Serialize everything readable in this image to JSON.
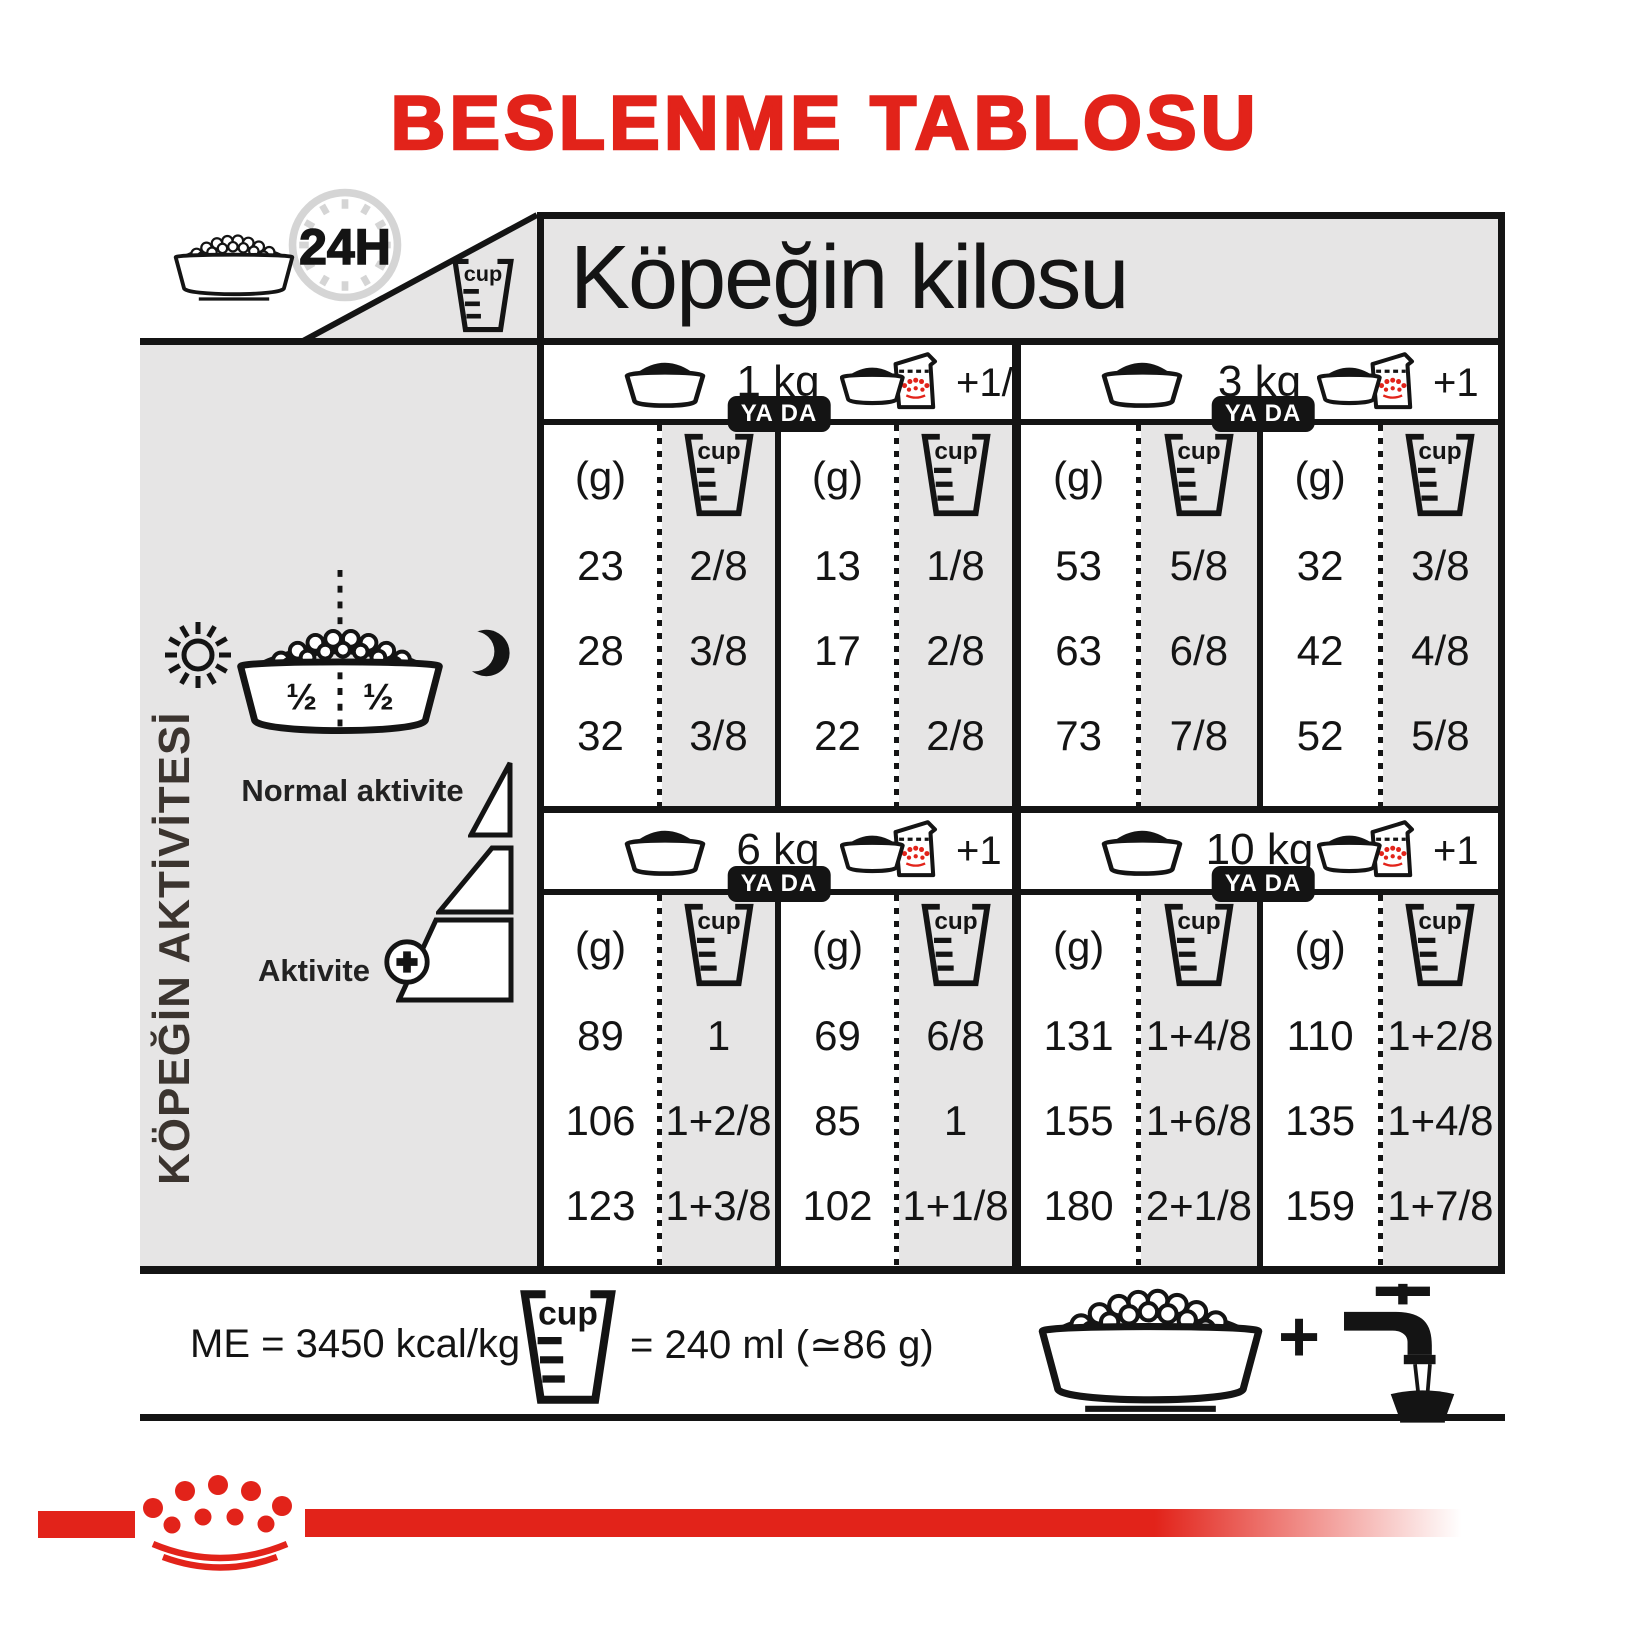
{
  "title": "BESLENME TABLOSU",
  "labels": {
    "cup": "cup",
    "hours": "24H",
    "grams": "(g)",
    "or": "YA DA",
    "plus": "+"
  },
  "weight_header": "Köpeğin kilosu",
  "sidebar": {
    "axis_label": "KÖPEĞİN AKTİVİTESİ",
    "half_left": "½",
    "half_right": "½",
    "normal_activity": "Normal aktivite",
    "activity": "Aktivite"
  },
  "sections": [
    {
      "weight": "1 kg",
      "add": "+1/2",
      "dry_g": [
        "23",
        "28",
        "32"
      ],
      "dry_cup": [
        "2/8",
        "3/8",
        "3/8"
      ],
      "mix_g": [
        "13",
        "17",
        "22"
      ],
      "mix_cup": [
        "1/8",
        "2/8",
        "2/8"
      ]
    },
    {
      "weight": "3 kg",
      "add": "+1",
      "dry_g": [
        "53",
        "63",
        "73"
      ],
      "dry_cup": [
        "5/8",
        "6/8",
        "7/8"
      ],
      "mix_g": [
        "32",
        "42",
        "52"
      ],
      "mix_cup": [
        "3/8",
        "4/8",
        "5/8"
      ]
    },
    {
      "weight": "6 kg",
      "add": "+1",
      "dry_g": [
        "89",
        "106",
        "123"
      ],
      "dry_cup": [
        "1",
        "1+2/8",
        "1+3/8"
      ],
      "mix_g": [
        "69",
        "85",
        "102"
      ],
      "mix_cup": [
        "6/8",
        "1",
        "1+1/8"
      ]
    },
    {
      "weight": "10 kg",
      "add": "+1",
      "dry_g": [
        "131",
        "155",
        "180"
      ],
      "dry_cup": [
        "1+4/8",
        "1+6/8",
        "2+1/8"
      ],
      "mix_g": [
        "110",
        "135",
        "159"
      ],
      "mix_cup": [
        "1+2/8",
        "1+4/8",
        "1+7/8"
      ]
    }
  ],
  "footer": {
    "me": "ME = 3450 kcal/kg",
    "cup_equiv": "= 240 ml (≃86 g)"
  },
  "colors": {
    "red": "#e2231a",
    "gray": "#e6e5e5",
    "ink": "#141414"
  }
}
